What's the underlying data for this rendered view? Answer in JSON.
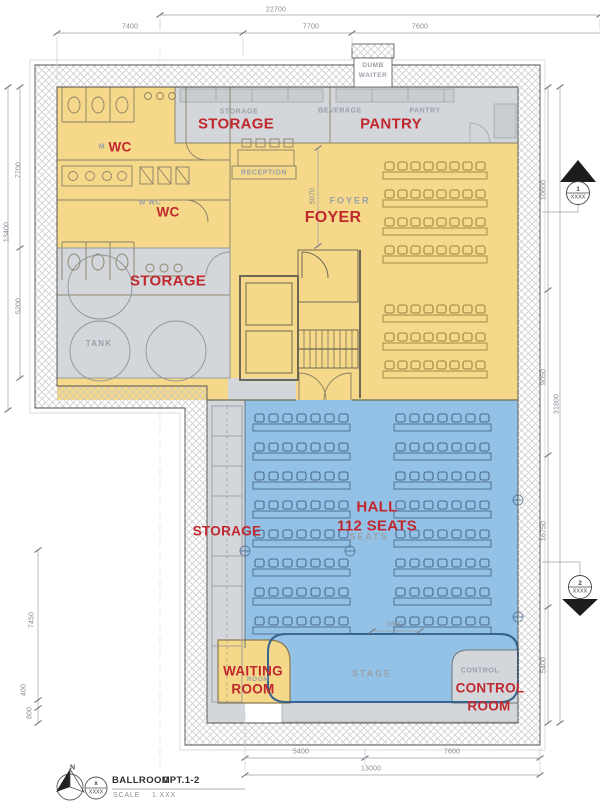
{
  "colors": {
    "yellow": "#f5d88a",
    "blue": "#94c2e6",
    "grayroom": "#d3d7db",
    "red": "#c0282e"
  },
  "rooms": {
    "storage_top": {
      "label": "STORAGE",
      "small": "STORAGE"
    },
    "pantry": {
      "label": "PANTRY",
      "small_left": "BEVERAGE",
      "small_right": "PANTRY"
    },
    "dumb_waiter": {
      "line1": "DUMB",
      "line2": "WAITER"
    },
    "wc_men": {
      "label": "WC",
      "prefix": "M"
    },
    "wc_women": {
      "label": "WC",
      "small": "W  WC"
    },
    "foyer": {
      "label": "FOYER",
      "small": "FOYER"
    },
    "reception": {
      "small": "RECEPTION"
    },
    "storage_mid": {
      "label": "STORAGE"
    },
    "tank": {
      "small": "TANK"
    },
    "hall": {
      "label_line1": "HALL",
      "label_line2": "112 SEATS",
      "small": "SEATS"
    },
    "storage_side": {
      "label": "STORAGE"
    },
    "waiting_room": {
      "line1": "WAITING",
      "line2": "ROOM",
      "small": "ROOM"
    },
    "stage": {
      "small": "STAGE"
    },
    "control_room": {
      "line1": "CONTROL",
      "line2": "ROOM",
      "small": "CONTROL"
    }
  },
  "dimensions": {
    "top_total": "22700",
    "top_1": "7400",
    "top_2": "7700",
    "top_3": "7600",
    "left_1": "7700",
    "left_2": "13400",
    "left_3": "5200",
    "left_low_1": "7450",
    "left_low_2": "400",
    "left_low_3": "800",
    "right_1": "10600",
    "right_2": "9050",
    "right_3": "16750",
    "right_4": "5400",
    "right_total": "31800",
    "bottom_1": "5400",
    "bottom_2": "7600",
    "bottom_total": "13000",
    "foyer_depth": "5070",
    "aisle": "1600"
  },
  "markers": {
    "section_1": {
      "num": "1",
      "ref": "XXXX"
    },
    "section_2": {
      "num": "2",
      "ref": "XXXX"
    }
  },
  "legend": {
    "north": "N",
    "ref_top": "x",
    "ref_bottom": "XXXX",
    "title": "BALLROOM",
    "variant": "OPT.1-2",
    "scale_label": "SCALE",
    "scale_value": "1:XXX"
  }
}
